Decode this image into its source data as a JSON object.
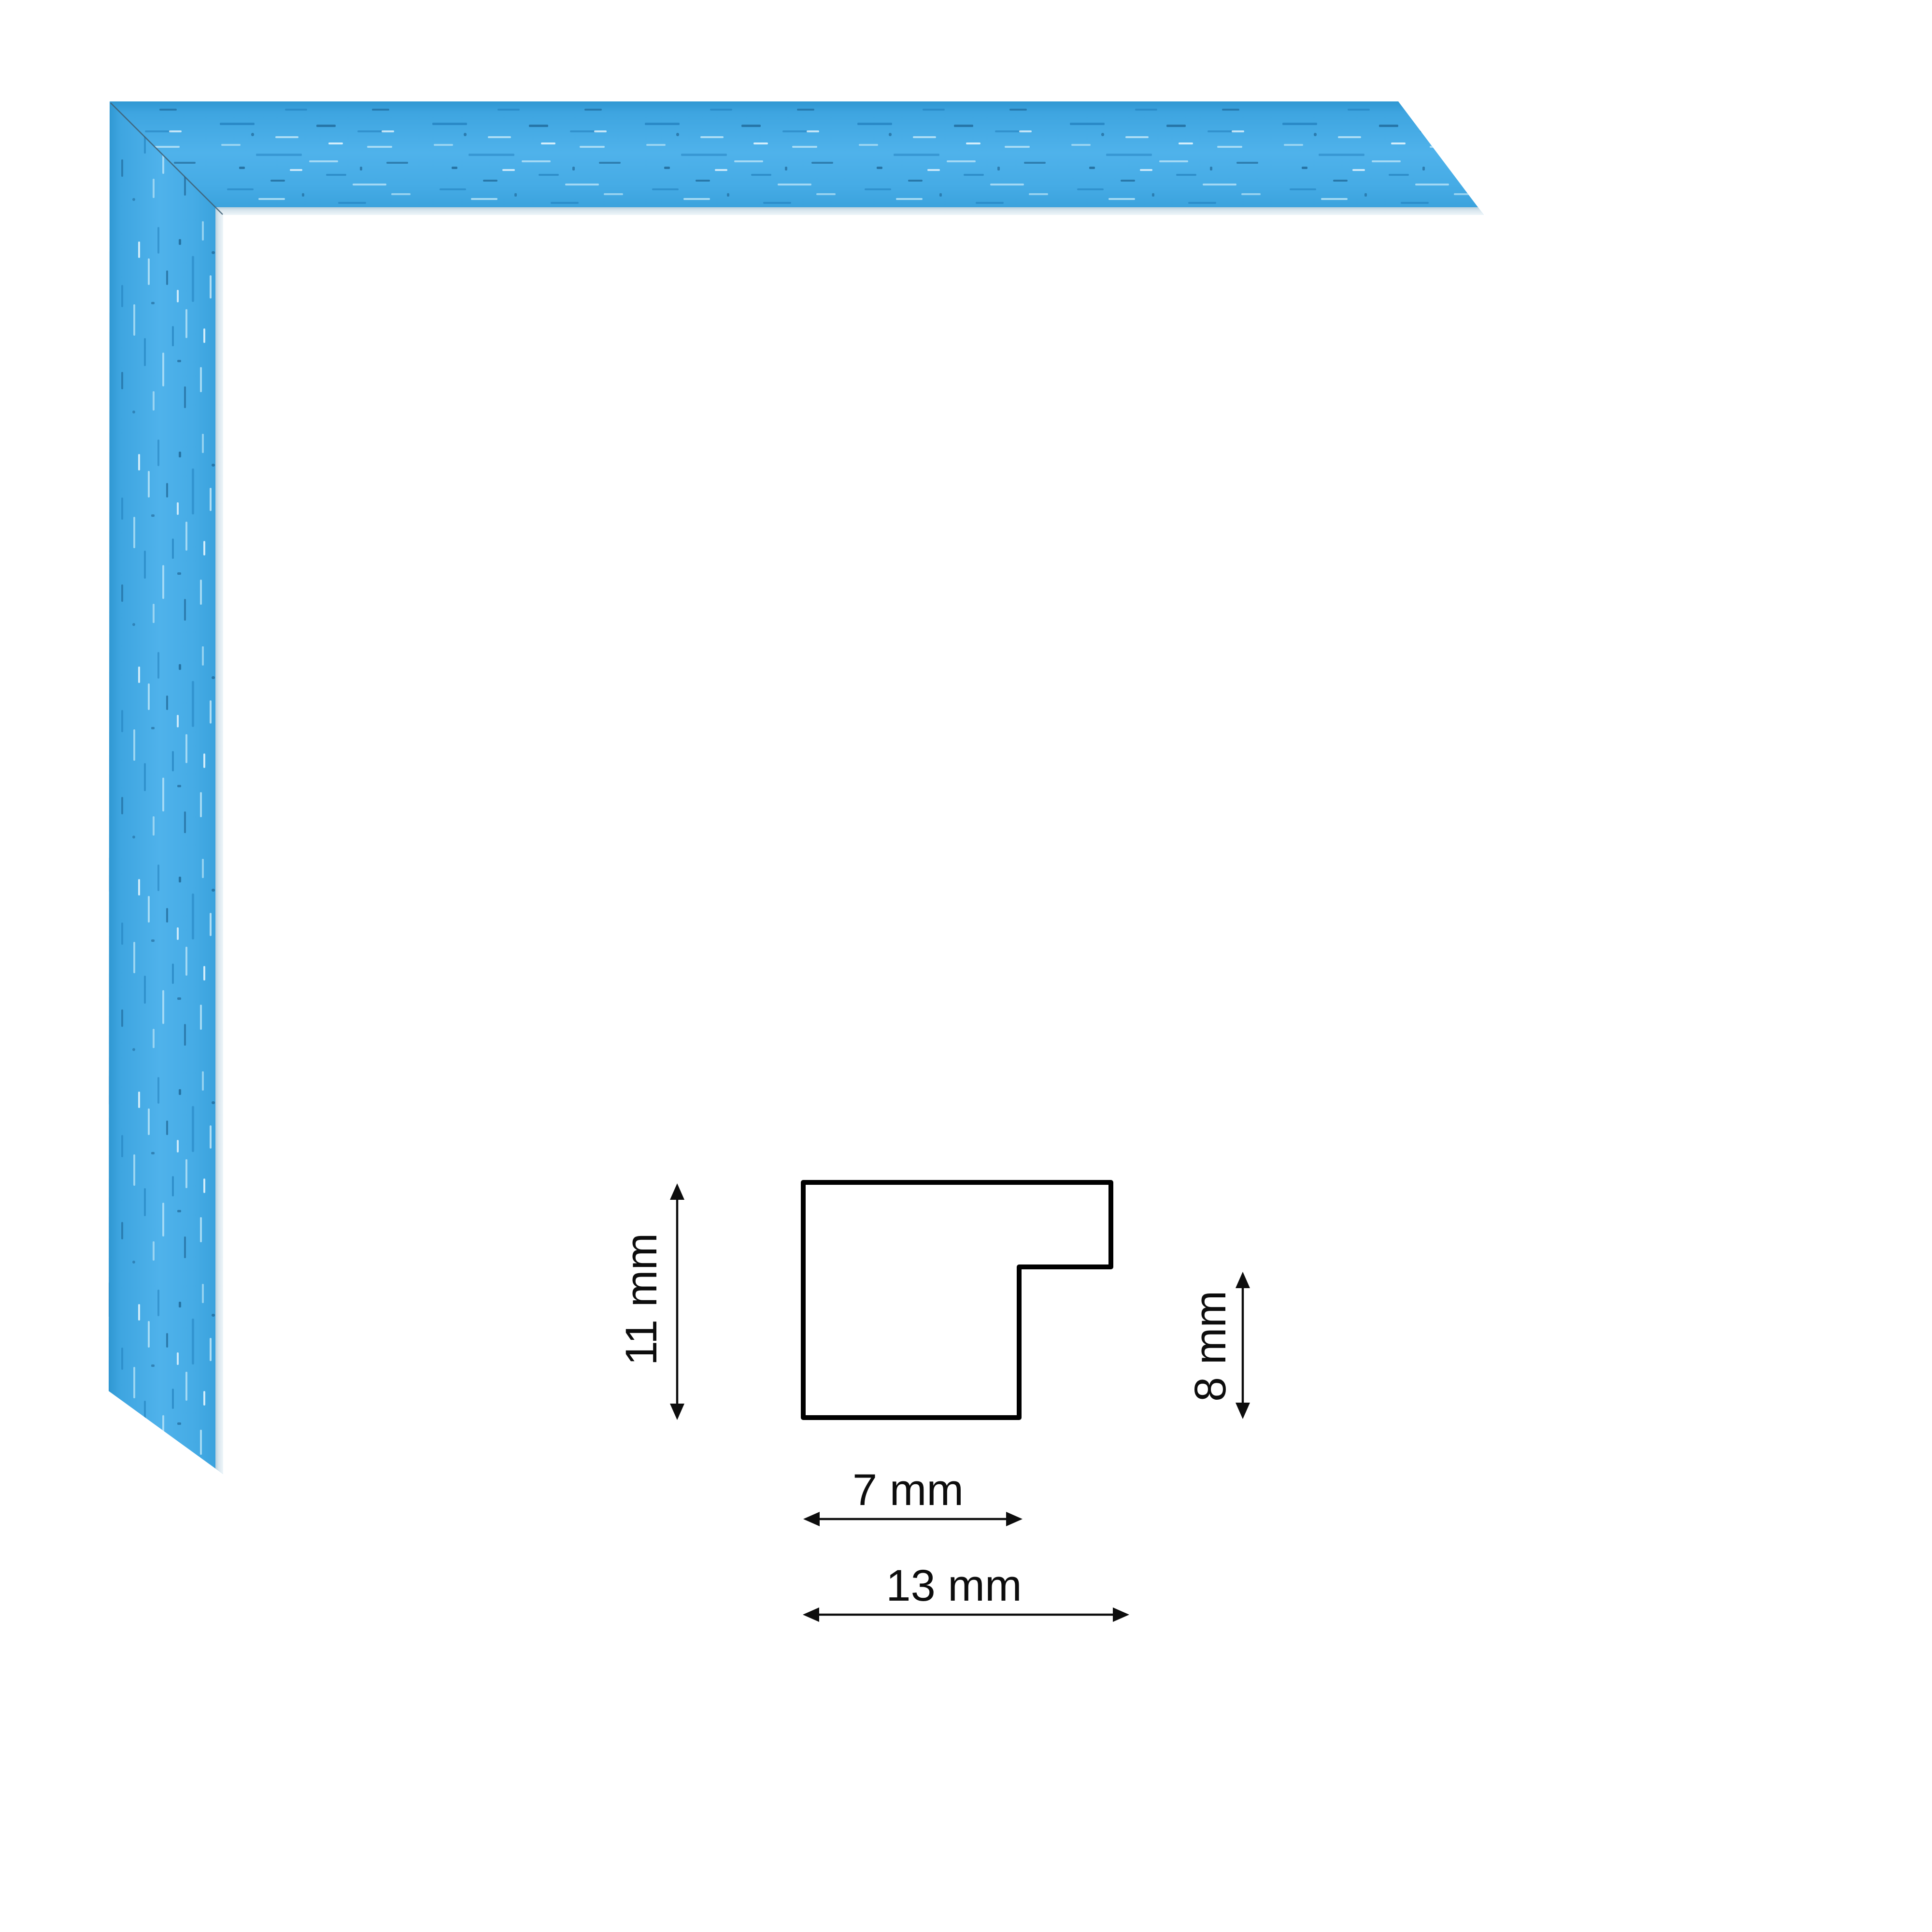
{
  "product": {
    "kind": "picture-frame moulding corner sample",
    "color_name": "blue",
    "colors": {
      "face": "#44A9E3",
      "face_highlight": "#52B3EB",
      "face_shadow": "#2E96D2",
      "grain_dark": "#1D7AB8",
      "grain_navy": "#0F4C78",
      "grain_light": "#B9E4F7",
      "inner_lip_light": "#EEF5F9",
      "inner_lip_shade": "#B7CFDD",
      "miter_joint_line": "#3F5F73"
    }
  },
  "diagram": {
    "stroke_color": "#000000",
    "dimensions": {
      "height": {
        "label": "11 mm",
        "value_mm": 11
      },
      "rebate_height": {
        "label": "8 mm",
        "value_mm": 8
      },
      "face_width": {
        "label": "7 mm",
        "value_mm": 7
      },
      "overall_width": {
        "label": "13 mm",
        "value_mm": 13
      }
    }
  }
}
